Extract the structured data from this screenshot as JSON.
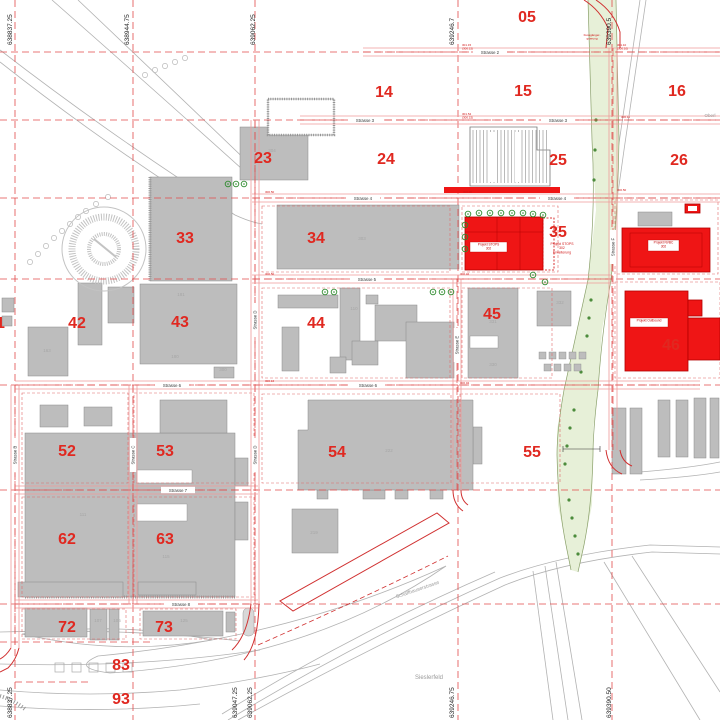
{
  "map_title": "Site development plan",
  "colors": {
    "background": "#ffffff",
    "building_fill": "#bdbdbd",
    "building_stroke": "#8a8a8a",
    "project_fill": "#ef1515",
    "project_stroke": "#b30000",
    "grid_red": "#e24b4b",
    "road_edge": "#ef9a9a",
    "road_dash": "#e05050",
    "cell_number": "#e02820",
    "faint_label": "#a6a6a6",
    "landscape_gray": "#b2b2b2",
    "green_fill": "#e7f0d8",
    "green_edge": "#8aa06a",
    "veg_green": "#4c8c3c",
    "tree_green": "#2e8b2e",
    "coord_text": "#222222",
    "street_text": "#333333"
  },
  "grid_cells": [
    {
      "label": "05",
      "x": 527,
      "y": 16
    },
    {
      "label": "14",
      "x": 384,
      "y": 91
    },
    {
      "label": "15",
      "x": 523,
      "y": 90
    },
    {
      "label": "16",
      "x": 677,
      "y": 90
    },
    {
      "label": "23",
      "x": 263,
      "y": 157
    },
    {
      "label": "24",
      "x": 386,
      "y": 158
    },
    {
      "label": "25",
      "x": 558,
      "y": 159
    },
    {
      "label": "26",
      "x": 679,
      "y": 159
    },
    {
      "label": "33",
      "x": 185,
      "y": 237
    },
    {
      "label": "34",
      "x": 316,
      "y": 237
    },
    {
      "label": "35",
      "x": 558,
      "y": 231
    },
    {
      "label": "41",
      "x": -4,
      "y": 322
    },
    {
      "label": "42",
      "x": 77,
      "y": 322
    },
    {
      "label": "43",
      "x": 180,
      "y": 321
    },
    {
      "label": "44",
      "x": 316,
      "y": 322
    },
    {
      "label": "45",
      "x": 492,
      "y": 313
    },
    {
      "label": "46",
      "x": 671,
      "y": 344
    },
    {
      "label": "52",
      "x": 67,
      "y": 450
    },
    {
      "label": "53",
      "x": 165,
      "y": 450
    },
    {
      "label": "54",
      "x": 337,
      "y": 451
    },
    {
      "label": "55",
      "x": 532,
      "y": 451
    },
    {
      "label": "62",
      "x": 67,
      "y": 538
    },
    {
      "label": "63",
      "x": 165,
      "y": 538
    },
    {
      "label": "72",
      "x": 67,
      "y": 626
    },
    {
      "label": "73",
      "x": 164,
      "y": 626
    },
    {
      "label": "83",
      "x": 121,
      "y": 664
    },
    {
      "label": "93",
      "x": 121,
      "y": 698
    }
  ],
  "coords_top": [
    {
      "label": "638837.25",
      "x": 12
    },
    {
      "label": "638944.75",
      "x": 129
    },
    {
      "label": "639062.25",
      "x": 255
    },
    {
      "label": "639246.7",
      "x": 454
    },
    {
      "label": "639390.5",
      "x": 611
    }
  ],
  "coords_bottom": [
    {
      "label": "638837.25",
      "x": 12
    },
    {
      "label": "639047.25",
      "x": 237
    },
    {
      "label": "639062.25",
      "x": 252
    },
    {
      "label": "639246.75",
      "x": 454
    },
    {
      "label": "639390.50",
      "x": 611
    }
  ],
  "grid_lines": {
    "vertical": [
      15,
      133,
      255,
      458,
      612
    ],
    "horizontal": [
      52,
      120,
      198,
      279,
      385,
      490,
      604
    ],
    "extra_h_segments": [
      [
        0,
        642,
        150
      ],
      [
        15,
        682,
        90
      ]
    ]
  },
  "streets_h": [
    {
      "name": "Strasse 2",
      "y": 52,
      "x1": 363,
      "x2": 720,
      "label_x": [
        490
      ]
    },
    {
      "name": "Strasse 3",
      "y": 120,
      "x1": 300,
      "x2": 720,
      "label_x": [
        365,
        558
      ]
    },
    {
      "name": "Strasse 4",
      "y": 198,
      "x1": 252,
      "x2": 720,
      "label_x": [
        363,
        557
      ]
    },
    {
      "name": "Strasse 5",
      "y": 279,
      "x1": 252,
      "x2": 612,
      "label_x": [
        367
      ]
    },
    {
      "name": "Strasse 6",
      "y": 385,
      "x1": 15,
      "x2": 700,
      "label_x": [
        172,
        368
      ]
    },
    {
      "name": "Strasse 7",
      "y": 490,
      "x1": 15,
      "x2": 258,
      "label_x": [
        178
      ]
    },
    {
      "name": "Strasse 8",
      "y": 604,
      "x1": 15,
      "x2": 258,
      "label_x": [
        181
      ]
    }
  ],
  "streets_v": [
    {
      "name": "Strasse B",
      "x": 15,
      "y1": 385,
      "y2": 648,
      "label_y": [
        455
      ]
    },
    {
      "name": "Strasse C",
      "x": 133,
      "y1": 385,
      "y2": 604,
      "label_y": [
        455
      ]
    },
    {
      "name": "Strasse D",
      "x": 255,
      "y1": 120,
      "y2": 604,
      "label_y": [
        320,
        455
      ]
    },
    {
      "name": "Strasse E",
      "x": 457,
      "y1": 279,
      "y2": 490,
      "label_y": [
        345
      ]
    },
    {
      "name": "Strasse F",
      "x": 613,
      "y1": 48,
      "y2": 450,
      "label_y": [
        247
      ]
    }
  ],
  "block_outlines": [
    [
      262,
      206,
      188,
      66
    ],
    [
      462,
      206,
      96,
      66
    ],
    [
      262,
      288,
      188,
      90
    ],
    [
      462,
      288,
      90,
      90
    ],
    [
      22,
      393,
      106,
      90
    ],
    [
      134,
      393,
      120,
      90
    ],
    [
      262,
      394,
      189,
      89
    ],
    [
      460,
      394,
      100,
      89
    ],
    [
      22,
      497,
      106,
      100
    ],
    [
      134,
      497,
      120,
      100
    ],
    [
      22,
      609,
      104,
      30
    ],
    [
      140,
      609,
      96,
      30
    ],
    [
      615,
      200,
      103,
      74
    ],
    [
      615,
      282,
      105,
      96
    ]
  ],
  "buildings": [
    {
      "r": [
        240,
        127,
        68,
        53
      ]
    },
    {
      "r": [
        150,
        177,
        82,
        104
      ],
      "hatch_left": true
    },
    {
      "r": [
        277,
        205,
        182,
        64
      ]
    },
    {
      "r": [
        78,
        283,
        24,
        62
      ]
    },
    {
      "r": [
        108,
        287,
        26,
        36
      ]
    },
    {
      "r": [
        28,
        327,
        40,
        49
      ]
    },
    {
      "r": [
        2,
        298,
        12,
        14
      ]
    },
    {
      "r": [
        2,
        316,
        10,
        10
      ]
    },
    {
      "r": [
        140,
        284,
        97,
        80
      ]
    },
    {
      "r": [
        214,
        367,
        20,
        11
      ]
    },
    {
      "r": [
        278,
        295,
        60,
        13
      ]
    },
    {
      "r": [
        340,
        288,
        20,
        72
      ]
    },
    {
      "r": [
        375,
        305,
        42,
        36
      ]
    },
    {
      "r": [
        406,
        322,
        48,
        56
      ]
    },
    {
      "r": [
        352,
        341,
        26,
        24
      ]
    },
    {
      "r": [
        282,
        327,
        17,
        44
      ]
    },
    {
      "r": [
        330,
        357,
        16,
        16
      ]
    },
    {
      "r": [
        366,
        295,
        12,
        9
      ]
    },
    {
      "r": [
        468,
        288,
        50,
        90
      ]
    },
    {
      "r": [
        537,
        291,
        34,
        35
      ]
    },
    {
      "r": [
        25,
        433,
        210,
        164
      ],
      "hatch_bottom": true
    },
    {
      "r": [
        160,
        400,
        67,
        33
      ]
    },
    {
      "r": [
        40,
        405,
        28,
        22
      ]
    },
    {
      "r": [
        84,
        407,
        28,
        19
      ]
    },
    {
      "r": [
        235,
        458,
        13,
        28
      ]
    },
    {
      "r": [
        235,
        502,
        13,
        38
      ]
    },
    {
      "r": [
        473,
        427,
        9,
        37
      ]
    },
    {
      "r": [
        292,
        509,
        46,
        44
      ]
    },
    {
      "r": [
        18,
        582,
        105,
        15
      ]
    },
    {
      "r": [
        138,
        582,
        58,
        13
      ]
    },
    {
      "r": [
        25,
        608,
        62,
        29
      ]
    },
    {
      "r": [
        90,
        609,
        17,
        31
      ]
    },
    {
      "r": [
        109,
        609,
        10,
        31
      ]
    },
    {
      "r": [
        143,
        611,
        80,
        25
      ]
    },
    {
      "r": [
        226,
        612,
        9,
        20
      ]
    },
    {
      "r": [
        638,
        212,
        34,
        14
      ]
    },
    {
      "r": [
        612,
        408,
        14,
        66
      ]
    },
    {
      "r": [
        630,
        408,
        12,
        66
      ]
    },
    {
      "r": [
        658,
        400,
        12,
        57
      ]
    },
    {
      "r": [
        676,
        400,
        12,
        57
      ]
    },
    {
      "r": [
        694,
        398,
        12,
        60
      ]
    },
    {
      "r": [
        710,
        398,
        9,
        60
      ]
    },
    {
      "r": [
        317,
        490,
        11,
        9
      ]
    },
    {
      "r": [
        363,
        490,
        22,
        9
      ]
    },
    {
      "r": [
        395,
        490,
        13,
        9
      ]
    },
    {
      "r": [
        430,
        490,
        13,
        9
      ]
    }
  ],
  "building_54_points": "298,430 308,430 308,400 473,400 473,490 298,490",
  "white_cutouts": [
    [
      470,
      336,
      28,
      12
    ],
    [
      137,
      470,
      55,
      13
    ],
    [
      137,
      504,
      50,
      17
    ]
  ],
  "house_row": {
    "y1": 352,
    "y2": 364,
    "xs1": [
      539,
      549,
      559,
      569,
      579
    ],
    "xs2": [
      544,
      554,
      564,
      574
    ],
    "size": 7
  },
  "comb_building": {
    "points": "470,127 537,127 537,150 550,150 550,186 470,186",
    "white_gaps": [
      [
        490,
        132,
        6,
        50
      ],
      [
        515,
        132,
        6,
        50
      ]
    ]
  },
  "hatch_building_23": [
    268,
    99,
    66,
    36
  ],
  "circle_structure": {
    "cx": 104,
    "cy": 249,
    "r_outer": 42,
    "r_mid": 32,
    "r_inner": 15
  },
  "allotments": {
    "y": 663,
    "xs": [
      55,
      72,
      89,
      106,
      123
    ],
    "size": 9
  },
  "island": [
    243,
    608,
    11,
    28
  ],
  "faint_labels": [
    {
      "t": "304",
      "x": 272,
      "y": 152
    },
    {
      "t": "303",
      "x": 362,
      "y": 240
    },
    {
      "t": "181",
      "x": 181,
      "y": 296
    },
    {
      "t": "180",
      "x": 175,
      "y": 358
    },
    {
      "t": "300",
      "x": 223,
      "y": 371
    },
    {
      "t": "163",
      "x": 47,
      "y": 352
    },
    {
      "t": "110",
      "x": 354,
      "y": 310
    },
    {
      "t": "331",
      "x": 493,
      "y": 323
    },
    {
      "t": "330",
      "x": 493,
      "y": 366
    },
    {
      "t": "332",
      "x": 560,
      "y": 304
    },
    {
      "t": "111",
      "x": 83,
      "y": 516
    },
    {
      "t": "115",
      "x": 166,
      "y": 558
    },
    {
      "t": "222",
      "x": 389,
      "y": 452
    },
    {
      "t": "219",
      "x": 314,
      "y": 534
    },
    {
      "t": "107",
      "x": 98,
      "y": 622
    },
    {
      "t": "106",
      "x": 117,
      "y": 622
    },
    {
      "t": "125",
      "x": 184,
      "y": 622
    }
  ],
  "projects": {
    "stops": {
      "rect": [
        465,
        217,
        78,
        53
      ],
      "box": [
        470,
        242,
        37,
        10
      ],
      "box_lines": [
        "Projekt STOPS",
        "302"
      ]
    },
    "stops_ext": {
      "dash_rect": [
        543,
        218,
        11,
        52
      ],
      "text_x": 562,
      "text_y": 245,
      "lines": [
        "Projekt STOPS",
        "302",
        "Erweiterung"
      ]
    },
    "nvbc": {
      "rect": [
        622,
        228,
        88,
        44
      ],
      "inner": [
        630,
        233,
        72,
        34
      ],
      "box": [
        648,
        240,
        31,
        11
      ],
      "box_lines": [
        "Projekt NVBC",
        "302"
      ]
    },
    "small_red_box": [
      685,
      204,
      15,
      9
    ],
    "outbound": {
      "rects": [
        [
          625,
          291,
          63,
          80
        ],
        [
          688,
          318,
          32,
          42
        ],
        [
          688,
          300,
          14,
          16
        ]
      ],
      "box": [
        630,
        318,
        38,
        9
      ],
      "box_lines": [
        "Projekt Outbound"
      ]
    },
    "red_strip_strasse4": [
      444,
      187,
      116,
      6
    ]
  },
  "elevation_marks": [
    {
      "lines": [
        "301.15",
        "(300.15)"
      ],
      "x": 462,
      "y": 46
    },
    {
      "lines": [
        "301.10",
        "(300.10)"
      ],
      "x": 617,
      "y": 46
    },
    {
      "lines": [
        "301.54",
        "(300.15)"
      ],
      "x": 462,
      "y": 115
    },
    {
      "lines": [
        "300.11"
      ],
      "x": 621,
      "y": 118
    },
    {
      "lines": [
        "300.50"
      ],
      "x": 265,
      "y": 193
    },
    {
      "lines": [
        "300.90"
      ],
      "x": 463,
      "y": 193
    },
    {
      "lines": [
        "300.50"
      ],
      "x": 617,
      "y": 191
    },
    {
      "lines": [
        "300.50"
      ],
      "x": 265,
      "y": 275
    },
    {
      "lines": [
        "300.42"
      ],
      "x": 460,
      "y": 275
    },
    {
      "lines": [
        "300.16"
      ],
      "x": 265,
      "y": 382
    },
    {
      "lines": [
        "300.04"
      ],
      "x": 460,
      "y": 384
    }
  ],
  "misc_labels": [
    {
      "text": "Sieslerfeld",
      "x": 429,
      "y": 679,
      "size": 6,
      "color": "#9a9a9a",
      "rotate": 0
    },
    {
      "text": "Schaffhauserstrasse",
      "x": 418,
      "y": 591,
      "size": 5,
      "color": "#9a9a9a",
      "rotate": -19
    },
    {
      "text": "Oberl",
      "x": 710,
      "y": 117,
      "size": 4.5,
      "color": "#9a9a9a",
      "rotate": 0
    }
  ],
  "green_note": {
    "x": 592,
    "y": 36,
    "lines": [
      "Fussgänger-",
      "querung"
    ]
  },
  "trees": [
    [
      468,
      214
    ],
    [
      479,
      213
    ],
    [
      490,
      213
    ],
    [
      501,
      213
    ],
    [
      512,
      213
    ],
    [
      523,
      213
    ],
    [
      533,
      214
    ],
    [
      543,
      215
    ],
    [
      465,
      225
    ],
    [
      465,
      237
    ],
    [
      465,
      249
    ],
    [
      533,
      275
    ],
    [
      545,
      282
    ],
    [
      325,
      292
    ],
    [
      334,
      292
    ],
    [
      433,
      292
    ],
    [
      442,
      292
    ],
    [
      451,
      292
    ],
    [
      228,
      184
    ],
    [
      236,
      184
    ],
    [
      244,
      184
    ]
  ],
  "veg_dots": [
    [
      596,
      120
    ],
    [
      595,
      150
    ],
    [
      594,
      180
    ],
    [
      591,
      300
    ],
    [
      589,
      318
    ],
    [
      587,
      336
    ],
    [
      584,
      354
    ],
    [
      581,
      372
    ],
    [
      574,
      410
    ],
    [
      570,
      428
    ],
    [
      567,
      446
    ],
    [
      565,
      464
    ],
    [
      569,
      500
    ],
    [
      572,
      518
    ],
    [
      575,
      536
    ],
    [
      578,
      554
    ]
  ],
  "green_band": {
    "polygon": "588,0 616,0 619,140 618,210 611,280 602,330 598,390 593,430 593,455 592,505 584,545 578,572 571,570 566,545 558,505 557,455 557,430 564,390 577,330 588,280 596,210 592,140",
    "left_edge": "M588,0 L592,140 Q596,210 588,280 Q577,330 564,390 Q557,430 557,455 Q558,505 566,545 L571,570",
    "right_edge": "M616,0 L619,140 Q618,210 611,280 Q602,330 598,390 Q593,430 593,455 Q592,505 584,545 L578,572"
  },
  "landscape_paths": [
    {
      "d": "M52,0 Q160,95 252,178"
    },
    {
      "d": "M78,0 Q175,92 258,172"
    },
    {
      "d": "M0,50 Q110,135 235,215 Q250,222 262,224"
    },
    {
      "d": "M0,62 Q105,145 228,222"
    },
    {
      "d": "M640,0 L618,150 L597,300"
    },
    {
      "d": "M646,0 L624,150 L603,300"
    },
    {
      "d": "M228,720 Q360,640 500,578 Q560,555 650,545 L720,547"
    },
    {
      "d": "M238,720 Q368,648 505,585 Q562,562 652,552 L720,554"
    },
    {
      "d": "M222,714 Q350,635 495,572"
    },
    {
      "d": "M545,566 L568,720"
    },
    {
      "d": "M556,562 L582,720"
    },
    {
      "d": "M533,571 L553,720"
    },
    {
      "d": "M0,632 Q130,628 240,641"
    },
    {
      "d": "M0,664 Q140,668 260,650"
    },
    {
      "d": "M0,690 Q90,698 180,690 Q260,680 320,664"
    },
    {
      "d": "M0,706 Q100,714 200,704"
    },
    {
      "d": "M22,634 Q120,621 212,640 Q118,656 22,634 Z"
    },
    {
      "d": "M98,656 Q290,638 446,566 Q310,660 110,673 Q70,668 98,656 Z"
    },
    {
      "d": "M604,562 L700,720"
    },
    {
      "d": "M632,556 L720,692"
    },
    {
      "d": "M640,472 Q690,468 720,462"
    },
    {
      "d": "M640,480 Q692,477 720,472"
    }
  ],
  "red_paths": [
    {
      "d": "M280,601 293,611 449,523 437,513 Z",
      "dash": false
    },
    {
      "d": "M258,645 Q360,600 448,556",
      "dash": true
    },
    {
      "d": "M11,648 Q6,656 0,659",
      "dash": false
    },
    {
      "d": "M19,648 Q16,660 8,668 L0,672",
      "dash": false
    },
    {
      "d": "M251,604 Q247,636 232,650",
      "dash": false
    },
    {
      "d": "M259,604 Q258,644 244,660",
      "dash": false
    },
    {
      "d": "M453,490 Q453,504 463,511",
      "dash": false
    },
    {
      "d": "M461,490 Q461,500 468,505",
      "dash": false
    },
    {
      "d": "M606,450 Q608,468 622,474",
      "dash": false
    },
    {
      "d": "M620,450 Q622,462 632,466",
      "dash": false
    },
    {
      "d": "M584,0 Q600,10 608,28 L606,48",
      "dash": false
    },
    {
      "d": "M596,0 Q614,12 620,32 L620,48",
      "dash": false
    }
  ]
}
